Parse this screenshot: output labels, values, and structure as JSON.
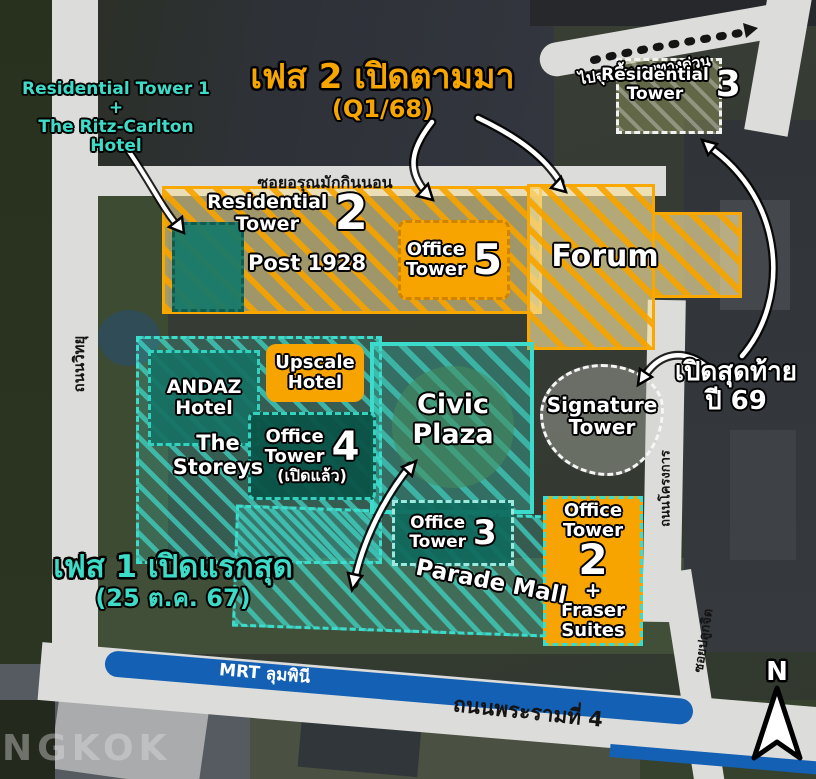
{
  "phase2": {
    "title": "เฟส 2 เปิดตามมา",
    "sub": "(Q1/68)"
  },
  "phase1": {
    "title": "เฟส 1 เปิดแรกสุด",
    "sub": "(25 ต.ค. 67)"
  },
  "last_open": {
    "line1": "เปิดสุดท้าย",
    "line2": "ปี 69"
  },
  "res1_note": {
    "line1": "Residential Tower 1",
    "line2": "+",
    "line3": "The Ritz-Carlton",
    "line4": "Hotel"
  },
  "expressway_note": "ไปจุดขึ้น-ลงทางด่วน",
  "zones": {
    "res2": {
      "l1": "Residential",
      "l2": "Tower",
      "num": "2"
    },
    "post1928": {
      "label": "Post 1928"
    },
    "office5": {
      "l1": "Office",
      "l2": "Tower",
      "num": "5"
    },
    "forum": {
      "label": "Forum"
    },
    "res3": {
      "l1": "Residential",
      "l2": "Tower",
      "num": "3"
    },
    "andaz": {
      "l1": "ANDAZ",
      "l2": "Hotel"
    },
    "upscale": {
      "l1": "Upscale",
      "l2": "Hotel"
    },
    "civic": {
      "l1": "Civic",
      "l2": "Plaza"
    },
    "signature": {
      "l1": "Signature",
      "l2": "Tower"
    },
    "storeys": {
      "l1": "The",
      "l2": "Storeys"
    },
    "office4": {
      "l1": "Office",
      "l2": "Tower",
      "num": "4",
      "note": "(เปิดแล้ว)"
    },
    "office3": {
      "l1": "Office",
      "l2": "Tower",
      "num": "3"
    },
    "parade": {
      "label": "Parade Mall"
    },
    "office2": {
      "l1": "Office",
      "l2": "Tower",
      "num": "2",
      "plus": "+",
      "l3": "Fraser",
      "l4": "Suites"
    }
  },
  "roads": {
    "soi_arun": "ซอยอรุณมักกินนอน",
    "witthayu": "ถนนวิทยุ",
    "project": "ถนนโครงการ",
    "pluk_chit": "ซอยปลูกจิต",
    "rama4": "ถนนพระรามที่ 4",
    "mrt": "MRT ลุมพินี"
  },
  "compass": "N",
  "watermark": "NGKOK",
  "colors": {
    "orange": "#f7a600",
    "teal": "#3ddcc8",
    "teal_dark": "#0f6152",
    "mrt_blue": "#1360b4",
    "road_gray": "#dcdcda"
  }
}
